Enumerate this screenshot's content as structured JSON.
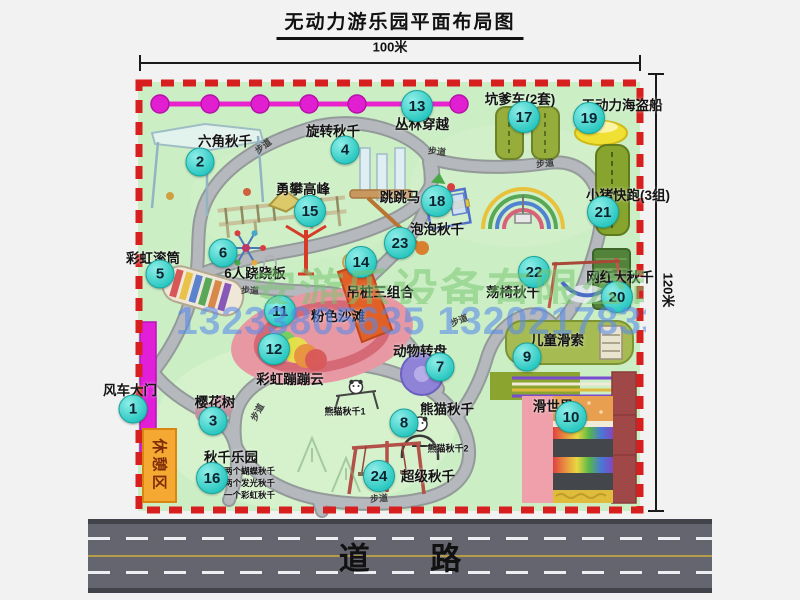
{
  "title": "无动力游乐园平面布局图",
  "dimensions": {
    "top": "100米",
    "right": "120米"
  },
  "road": {
    "label": "道 路"
  },
  "watermark": {
    "company": "安游乐设备有限公司",
    "phone": "13233805635 13202178333"
  },
  "labels": {
    "trail": "步道",
    "rest_area": "休憩区"
  },
  "attractions": [
    {
      "num": "1",
      "name": "风车大门"
    },
    {
      "num": "2",
      "name": "六角秋千"
    },
    {
      "num": "3",
      "name": "樱花树"
    },
    {
      "num": "4",
      "name": "旋转秋千"
    },
    {
      "num": "5",
      "name": "彩虹滚筒"
    },
    {
      "num": "6",
      "name": "6人跷跷板"
    },
    {
      "num": "7",
      "name": "动物转盘"
    },
    {
      "num": "8",
      "name": "熊猫秋千"
    },
    {
      "num": "9",
      "name": "儿童滑索"
    },
    {
      "num": "10",
      "name": "滑世界"
    },
    {
      "num": "11",
      "name": "粉色沙滩"
    },
    {
      "num": "12",
      "name": "彩虹蹦蹦云"
    },
    {
      "num": "13",
      "name": "丛林穿越"
    },
    {
      "num": "14",
      "name": "吊桩三组合"
    },
    {
      "num": "15",
      "name": "勇攀高峰"
    },
    {
      "num": "16",
      "name": "秋千乐园"
    },
    {
      "num": "17",
      "name": "坑爹车(2套)"
    },
    {
      "num": "18",
      "name": "跳跳马"
    },
    {
      "num": "19",
      "name": "无动力海盗船"
    },
    {
      "num": "20",
      "name": "网红大秋千"
    },
    {
      "num": "21",
      "name": "小猪快跑(3组)"
    },
    {
      "num": "22",
      "name": "荡椅秋千"
    },
    {
      "num": "23",
      "name": "泡泡秋千"
    },
    {
      "num": "24",
      "name": "超级秋千"
    }
  ],
  "annotations": {
    "panda_swing_1": "熊猫秋千1",
    "panda_swing_2": "熊猫秋千2",
    "swing_park_items": [
      "两个蝴蝶秋千",
      "两个发光秋千",
      "一个彩虹秋千"
    ]
  },
  "colors": {
    "map_green": "#cbeec5",
    "border_red": "#d81f1f",
    "badge_teal": "#2bc8c1",
    "path_gray": "#b5b8bc",
    "road_gray": "#65656f",
    "zipline_magenta": "#e822cc",
    "gate_magenta": "#e11fd8",
    "rest_area_orange": "#f5a832"
  }
}
